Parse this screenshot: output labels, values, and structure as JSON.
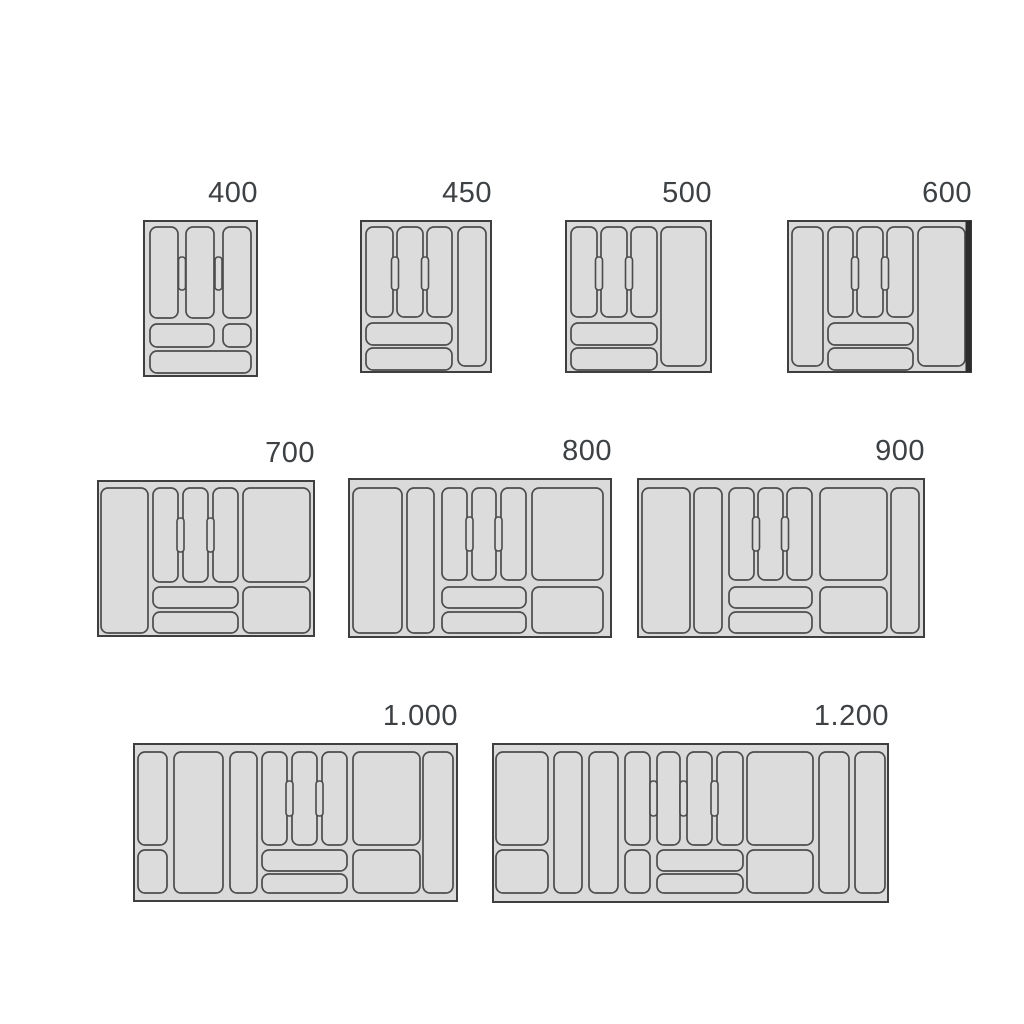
{
  "diagram": {
    "name": "cutlery-tray-insert-sizes",
    "background": "#ffffff",
    "colors": {
      "tray_fill": "#d9dad9",
      "compartment_fill": "#dbdcdb",
      "outline": "#4c4c4c",
      "outer_outline": "#3f3f3f",
      "label_color": "#3e4144",
      "cut_edge": "#2c2c2c"
    },
    "trays": [
      {
        "id": "400",
        "label": "400",
        "x": 143,
        "y": 220,
        "w": 115,
        "h": 157,
        "cut_right_edge": false,
        "compartments": [
          [
            7,
            7,
            28,
            91
          ],
          [
            43,
            7,
            28,
            91
          ],
          [
            80,
            7,
            28,
            91
          ],
          [
            7,
            104,
            64,
            23
          ],
          [
            80,
            104,
            28,
            23
          ],
          [
            7,
            131,
            101,
            22
          ]
        ],
        "pills": [
          [
            39,
            37,
            33
          ],
          [
            75.5,
            37,
            33
          ]
        ]
      },
      {
        "id": "450",
        "label": "450",
        "x": 360,
        "y": 220,
        "w": 132,
        "h": 153,
        "cut_right_edge": false,
        "compartments": [
          [
            6,
            7,
            27,
            90
          ],
          [
            37,
            7,
            26,
            90
          ],
          [
            67,
            7,
            25,
            90
          ],
          [
            98,
            7,
            28,
            139
          ],
          [
            6,
            103,
            86,
            22
          ],
          [
            6,
            128,
            86,
            22
          ]
        ],
        "pills": [
          [
            35,
            37,
            33
          ],
          [
            65,
            37,
            33
          ]
        ]
      },
      {
        "id": "500",
        "label": "500",
        "x": 565,
        "y": 220,
        "w": 147,
        "h": 153,
        "cut_right_edge": false,
        "compartments": [
          [
            6,
            7,
            26,
            90
          ],
          [
            36,
            7,
            26,
            90
          ],
          [
            66,
            7,
            26,
            90
          ],
          [
            96,
            7,
            45,
            139
          ],
          [
            6,
            103,
            86,
            22
          ],
          [
            6,
            128,
            86,
            22
          ]
        ],
        "pills": [
          [
            34,
            37,
            33
          ],
          [
            64,
            37,
            33
          ]
        ]
      },
      {
        "id": "600",
        "label": "600",
        "x": 787,
        "y": 220,
        "w": 185,
        "h": 153,
        "cut_right_edge": true,
        "compartments": [
          [
            5,
            7,
            31,
            139
          ],
          [
            41,
            7,
            25,
            90
          ],
          [
            70,
            7,
            26,
            90
          ],
          [
            100,
            7,
            26,
            90
          ],
          [
            131,
            7,
            47,
            139
          ],
          [
            41,
            103,
            85,
            22
          ],
          [
            41,
            128,
            85,
            22
          ]
        ],
        "pills": [
          [
            68,
            37,
            33
          ],
          [
            98,
            37,
            33
          ]
        ]
      },
      {
        "id": "700",
        "label": "700",
        "x": 97,
        "y": 480,
        "w": 218,
        "h": 157,
        "cut_right_edge": false,
        "compartments": [
          [
            4,
            8,
            47,
            145
          ],
          [
            56,
            8,
            25,
            94
          ],
          [
            86,
            8,
            25,
            94
          ],
          [
            116,
            8,
            25,
            94
          ],
          [
            146,
            8,
            67,
            94
          ],
          [
            56,
            107,
            85,
            21
          ],
          [
            56,
            132,
            85,
            21
          ],
          [
            146,
            107,
            67,
            46
          ]
        ],
        "pills": [
          [
            83.5,
            38,
            34
          ],
          [
            113.5,
            38,
            34
          ]
        ]
      },
      {
        "id": "800",
        "label": "800",
        "x": 348,
        "y": 478,
        "w": 264,
        "h": 160,
        "cut_right_edge": false,
        "compartments": [
          [
            5,
            10,
            49,
            145
          ],
          [
            59,
            10,
            27,
            145
          ],
          [
            94,
            10,
            25,
            92
          ],
          [
            124,
            10,
            24,
            92
          ],
          [
            153,
            10,
            25,
            92
          ],
          [
            184,
            10,
            71,
            92
          ],
          [
            94,
            109,
            84,
            21
          ],
          [
            94,
            134,
            84,
            21
          ],
          [
            184,
            109,
            71,
            46
          ]
        ],
        "pills": [
          [
            121.5,
            39,
            34
          ],
          [
            150.5,
            39,
            34
          ]
        ]
      },
      {
        "id": "900",
        "label": "900",
        "x": 637,
        "y": 478,
        "w": 288,
        "h": 160,
        "cut_right_edge": false,
        "compartments": [
          [
            5,
            10,
            48,
            145
          ],
          [
            57,
            10,
            28,
            145
          ],
          [
            92,
            10,
            25,
            92
          ],
          [
            121,
            10,
            25,
            92
          ],
          [
            150,
            10,
            25,
            92
          ],
          [
            183,
            10,
            67,
            92
          ],
          [
            254,
            10,
            28,
            145
          ],
          [
            92,
            109,
            83,
            21
          ],
          [
            92,
            134,
            83,
            21
          ],
          [
            183,
            109,
            67,
            46
          ]
        ],
        "pills": [
          [
            119,
            39,
            34
          ],
          [
            148,
            39,
            34
          ]
        ]
      },
      {
        "id": "1000",
        "label": "1.000",
        "x": 133,
        "y": 743,
        "w": 325,
        "h": 159,
        "cut_right_edge": false,
        "compartments": [
          [
            5,
            9,
            29,
            93
          ],
          [
            5,
            107,
            29,
            43
          ],
          [
            41,
            9,
            49,
            141
          ],
          [
            97,
            9,
            27,
            141
          ],
          [
            129,
            9,
            25,
            93
          ],
          [
            159,
            9,
            25,
            93
          ],
          [
            189,
            9,
            25,
            93
          ],
          [
            220,
            9,
            67,
            93
          ],
          [
            290,
            9,
            30,
            141
          ],
          [
            129,
            107,
            85,
            21
          ],
          [
            129,
            131,
            85,
            19
          ],
          [
            220,
            107,
            67,
            43
          ]
        ],
        "pills": [
          [
            156.5,
            38,
            35
          ],
          [
            186.5,
            38,
            35
          ]
        ]
      },
      {
        "id": "1200",
        "label": "1.200",
        "x": 492,
        "y": 743,
        "w": 397,
        "h": 160,
        "cut_right_edge": false,
        "compartments": [
          [
            4,
            9,
            52,
            93
          ],
          [
            4,
            107,
            52,
            43
          ],
          [
            62,
            9,
            28,
            141
          ],
          [
            97,
            9,
            29,
            141
          ],
          [
            133,
            9,
            25,
            93
          ],
          [
            133,
            107,
            25,
            43
          ],
          [
            165,
            9,
            23,
            93
          ],
          [
            195,
            9,
            25,
            93
          ],
          [
            225,
            9,
            26,
            93
          ],
          [
            255,
            9,
            66,
            93
          ],
          [
            327,
            9,
            30,
            141
          ],
          [
            363,
            9,
            30,
            141
          ],
          [
            165,
            107,
            86,
            21
          ],
          [
            165,
            131,
            86,
            19
          ],
          [
            255,
            107,
            66,
            43
          ]
        ],
        "pills": [
          [
            161.5,
            38,
            35
          ],
          [
            191.5,
            38,
            35
          ],
          [
            222.5,
            38,
            35
          ]
        ]
      }
    ]
  }
}
